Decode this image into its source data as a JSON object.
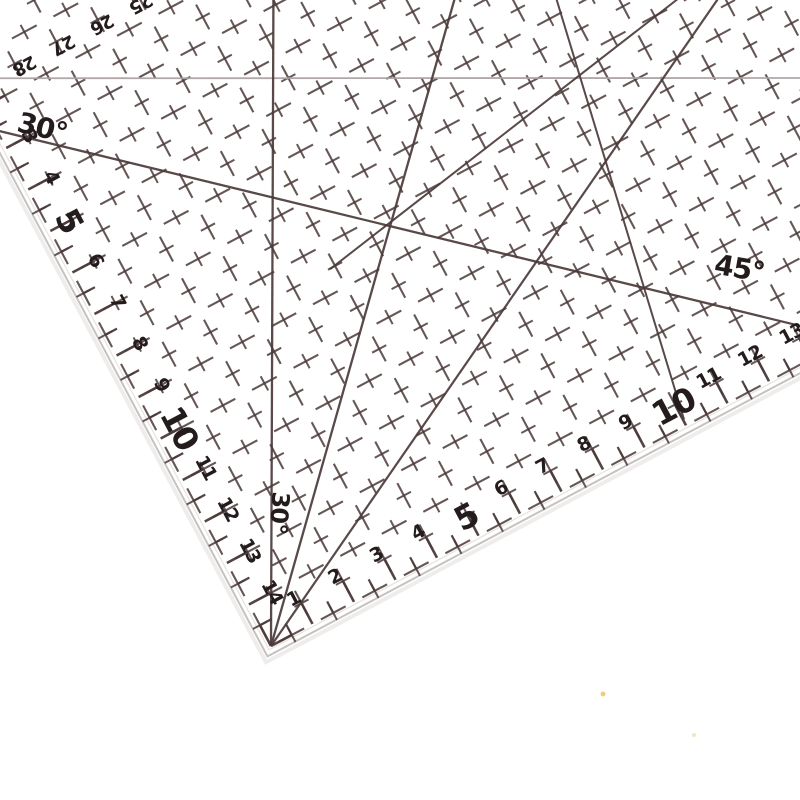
{
  "scene": {
    "description": "Transparent acrylic quilting patchwork ruler photographed at an angle on a white background",
    "background": "#ffffff"
  },
  "ruler": {
    "rotation_deg": -28,
    "corner": {
      "x": 271,
      "y": 646
    },
    "unit_px": 47,
    "grid": {
      "x0": 271,
      "y0": 646,
      "x_max": 1150,
      "y_min": -160,
      "dash": "28 19",
      "dash_offset": 37.5,
      "line_width": 2.1,
      "opacity": 0.85
    },
    "colors": {
      "ink": "#4b3a3a",
      "ink_dark": "#241c1c",
      "light_line": "#a9a1a1",
      "bevel": "#c6c2c0",
      "bevel_inner": "#e8e4e2",
      "shadow": "#efedec"
    },
    "scales": {
      "bottom": {
        "numbers": [
          1,
          2,
          3,
          4,
          5,
          6,
          7,
          8,
          9,
          10,
          11,
          12,
          13,
          14
        ],
        "bold": [
          5,
          10
        ]
      },
      "left": {
        "numbers": [
          3,
          4,
          5,
          6,
          7,
          8,
          9,
          10,
          11,
          12,
          13,
          14
        ],
        "bold": [
          5,
          10
        ]
      },
      "top_reversed": {
        "numbers": [
          28,
          27,
          26,
          25
        ],
        "x_start": 326,
        "x_step": 44,
        "y": 12
      }
    },
    "font": {
      "small": 19,
      "big": 33,
      "top": 18,
      "label": 27
    },
    "angle_labels": [
      {
        "text": "30°",
        "x": 306,
        "y": 88,
        "rot": 42,
        "size": 28
      },
      {
        "text": "45°",
        "x": 856,
        "y": 540,
        "rot": 38,
        "size": 28
      },
      {
        "text": "30°",
        "x": 334,
        "y": 528,
        "rot": 122,
        "size": 24
      }
    ],
    "angle_lines": [
      {
        "name": "line-30-parallel",
        "x1": 271,
        "y1": 3,
        "x2": 1150,
        "y2": 470,
        "w": 1.8,
        "light": true
      },
      {
        "name": "line-45-upper",
        "x1": 271,
        "y1": 62,
        "x2": 1010,
        "y2": 720,
        "w": 2.3
      },
      {
        "name": "line-45-corner",
        "x1": 271,
        "y1": 646,
        "x2": 949,
        "y2": -60,
        "w": 2.3
      },
      {
        "name": "line-60-corner",
        "x1": 271,
        "y1": 646,
        "x2": 653,
        "y2": -66,
        "w": 2.3
      },
      {
        "name": "line-30-corner",
        "x1": 271,
        "y1": 646,
        "x2": 1150,
        "y2": 191,
        "w": 2.2
      },
      {
        "name": "line-cross-a",
        "x1": 500,
        "y1": 341,
        "x2": 1030,
        "y2": 249,
        "w": 2.0
      },
      {
        "name": "line-cross-b",
        "x1": 742,
        "y1": 640,
        "x2": 856,
        "y2": 60,
        "w": 2.0
      }
    ]
  },
  "specks": [
    {
      "x": 603,
      "y": 694,
      "r": 2.5,
      "color": "#e6c35e"
    },
    {
      "x": 694,
      "y": 735,
      "r": 2.0,
      "color": "#eedfae"
    }
  ]
}
